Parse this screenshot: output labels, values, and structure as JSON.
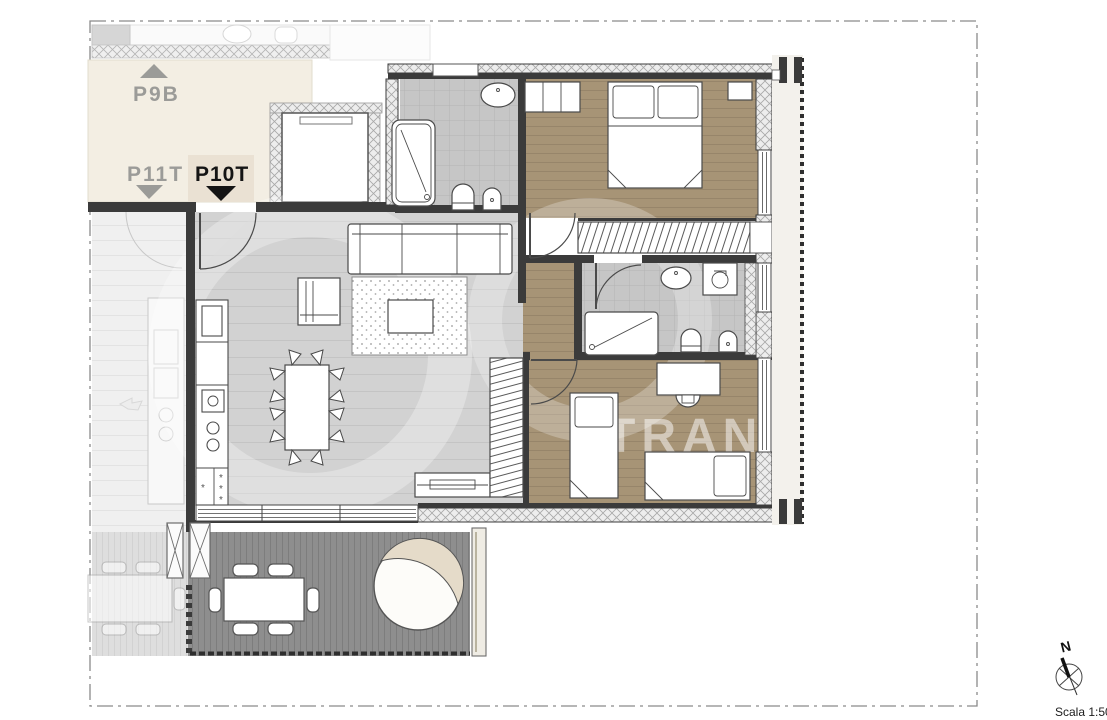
{
  "scale": {
    "label": "Scala 1:50"
  },
  "compass": {
    "north": "N"
  },
  "stairwell_labels": {
    "p9b": "P9B",
    "p11t": "P11T",
    "p10t": "P10T"
  },
  "watermark": {
    "fragment": "TRAN"
  },
  "symbols": {
    "vent": "*"
  },
  "colors": {
    "landing": "#f3eee3",
    "unit_highlight": "#eae1d3",
    "label_gray": "#9b9b98",
    "label_black": "#141414",
    "floor_living": "#d2d2d2",
    "floor_living_line": "#c4c4c4",
    "floor_wood": "#a79476",
    "floor_wood_line": "#97856a",
    "floor_tile": "#c6c6c6",
    "floor_tile_line": "#b4b4b4",
    "deck": "#8e8e8e",
    "deck_line": "#7d7d7d",
    "wall": "#3b3b3b",
    "watermark_white": "#ffffff"
  }
}
